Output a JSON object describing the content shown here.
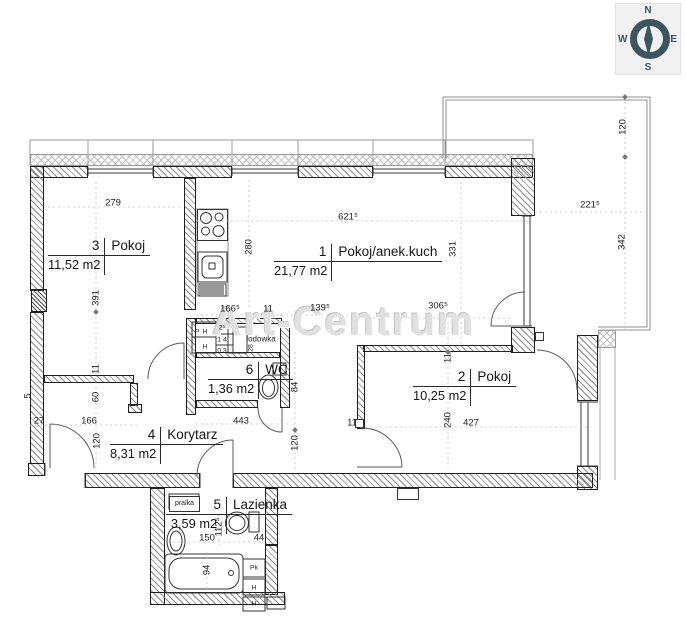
{
  "watermark": {
    "text": "Art-Centrum"
  },
  "compass": {
    "north": "N",
    "east": "E",
    "south": "S",
    "west": "W"
  },
  "colors": {
    "compass": "#3b5560",
    "wall_line": "#1f1f1f",
    "hatch": "#8a8a8a",
    "watermark": "#e0e0e0",
    "dim_text": "#1d1d1d"
  },
  "rooms": [
    {
      "num": "3",
      "name": "Pokoj",
      "area": "11,52 m2",
      "x": 48,
      "y": 238
    },
    {
      "num": "1",
      "name": "Pokoj/anek.kuch",
      "area": "21,77 m2",
      "x": 274,
      "y": 244
    },
    {
      "num": "2",
      "name": "Pokoj",
      "area": "10,25 m2",
      "x": 413,
      "y": 369
    },
    {
      "num": "6",
      "name": "WC",
      "area": "1,36 m2",
      "x": 208,
      "y": 362
    },
    {
      "num": "4",
      "name": "Korytarz",
      "area": "8,31 m2",
      "x": 110,
      "y": 427
    },
    {
      "num": "5",
      "name": "Lazienka",
      "area": "3,59 m2",
      "x": 166,
      "y": 497
    }
  ],
  "fixtures": {
    "washer_label": "pralka",
    "fridge_label": "lodowka"
  },
  "dimensions": [
    {
      "t": "279",
      "x": 113,
      "y": 203
    },
    {
      "t": "391",
      "x": 96,
      "y": 298,
      "r": 1
    },
    {
      "t": "280",
      "x": 249,
      "y": 247,
      "r": 1
    },
    {
      "t": "621⁵",
      "x": 348,
      "y": 217
    },
    {
      "t": "331",
      "x": 453,
      "y": 249,
      "r": 1
    },
    {
      "t": "120",
      "x": 623,
      "y": 127,
      "r": 1
    },
    {
      "t": "221⁵",
      "x": 590,
      "y": 205
    },
    {
      "t": "342",
      "x": 622,
      "y": 242,
      "r": 1
    },
    {
      "t": "166⁵",
      "x": 230,
      "y": 309
    },
    {
      "t": "11",
      "x": 268,
      "y": 309
    },
    {
      "t": "139⁵",
      "x": 320,
      "y": 308
    },
    {
      "t": "306⁵",
      "x": 438,
      "y": 306
    },
    {
      "t": "11",
      "x": 448,
      "y": 358,
      "r": 1
    },
    {
      "t": "240",
      "x": 448,
      "y": 420,
      "r": 1
    },
    {
      "t": "427",
      "x": 471,
      "y": 423
    },
    {
      "t": "84",
      "x": 295,
      "y": 387,
      "r": 1
    },
    {
      "t": "443",
      "x": 241,
      "y": 421
    },
    {
      "t": "120",
      "x": 295,
      "y": 443,
      "r": 1
    },
    {
      "t": "11",
      "x": 352,
      "y": 423
    },
    {
      "t": "120",
      "x": 97,
      "y": 441,
      "r": 1
    },
    {
      "t": "27",
      "x": 39,
      "y": 421
    },
    {
      "t": "166",
      "x": 89,
      "y": 421
    },
    {
      "t": "60",
      "x": 96,
      "y": 397,
      "r": 1
    },
    {
      "t": "11",
      "x": 96,
      "y": 369,
      "r": 1
    },
    {
      "t": "5",
      "x": 28,
      "y": 396,
      "r": 1
    },
    {
      "t": "150",
      "x": 207,
      "y": 538
    },
    {
      "t": "44",
      "x": 259,
      "y": 538
    },
    {
      "t": "112⁵",
      "x": 219,
      "y": 527,
      "r": 1
    },
    {
      "t": "94",
      "x": 207,
      "y": 570,
      "r": 1
    }
  ],
  "small_labels": [
    {
      "t": "P",
      "x": 197,
      "y": 332
    },
    {
      "t": "H",
      "x": 205,
      "y": 332
    },
    {
      "t": "H",
      "x": 205,
      "y": 347
    },
    {
      "t": "2⁵",
      "x": 222,
      "y": 328
    },
    {
      "t": "1 4",
      "x": 222,
      "y": 340
    },
    {
      "t": "0 3",
      "x": 222,
      "y": 351
    },
    {
      "t": "lodowka",
      "x": 261,
      "y": 339,
      "big": 1
    },
    {
      "t": "28",
      "x": 251,
      "y": 348,
      "r": 1
    },
    {
      "t": "Pk",
      "x": 254,
      "y": 568
    },
    {
      "t": "H",
      "x": 254,
      "y": 588
    },
    {
      "t": "H",
      "x": 254,
      "y": 604
    }
  ]
}
